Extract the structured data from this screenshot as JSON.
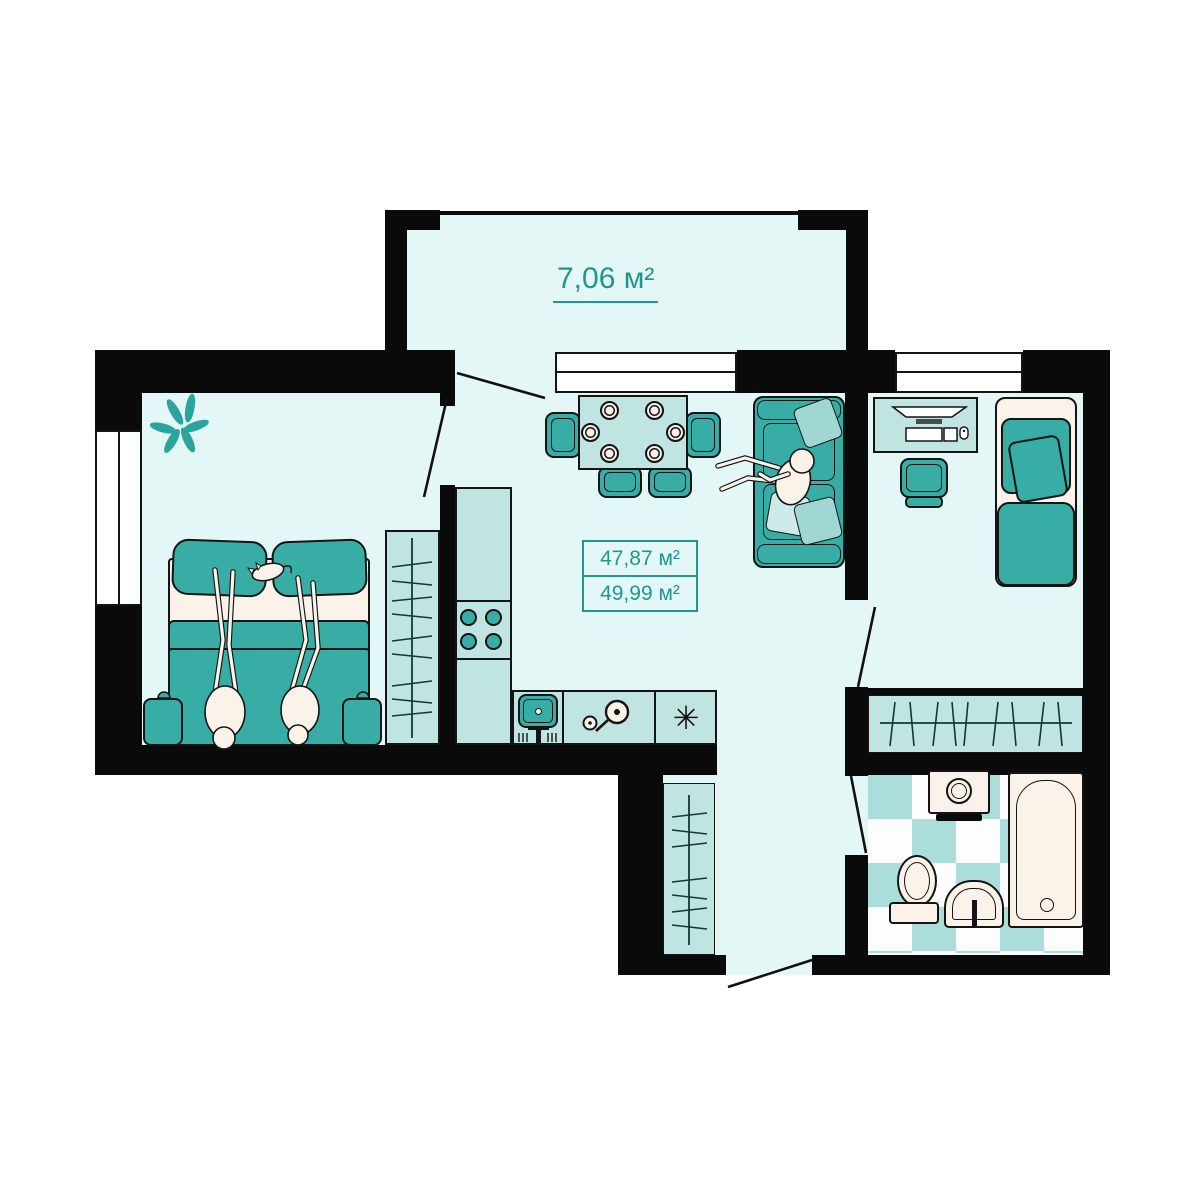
{
  "plan": {
    "labels": {
      "balcony_area": "7,06 м²",
      "living_area": "47,87 м²",
      "total_area": "49,99 м²"
    },
    "icons": {
      "fridge_asterisk": "✳"
    },
    "palette": {
      "wall": "#0a0a0a",
      "room_fill": "#e3f7f6",
      "furniture_light": "#c0e4e1",
      "accent_teal": "#38ada6",
      "cream": "#fbf2e9",
      "label_teal": "#21968f",
      "tile_teal": "#abdedb",
      "canvas": "#ffffff"
    }
  }
}
